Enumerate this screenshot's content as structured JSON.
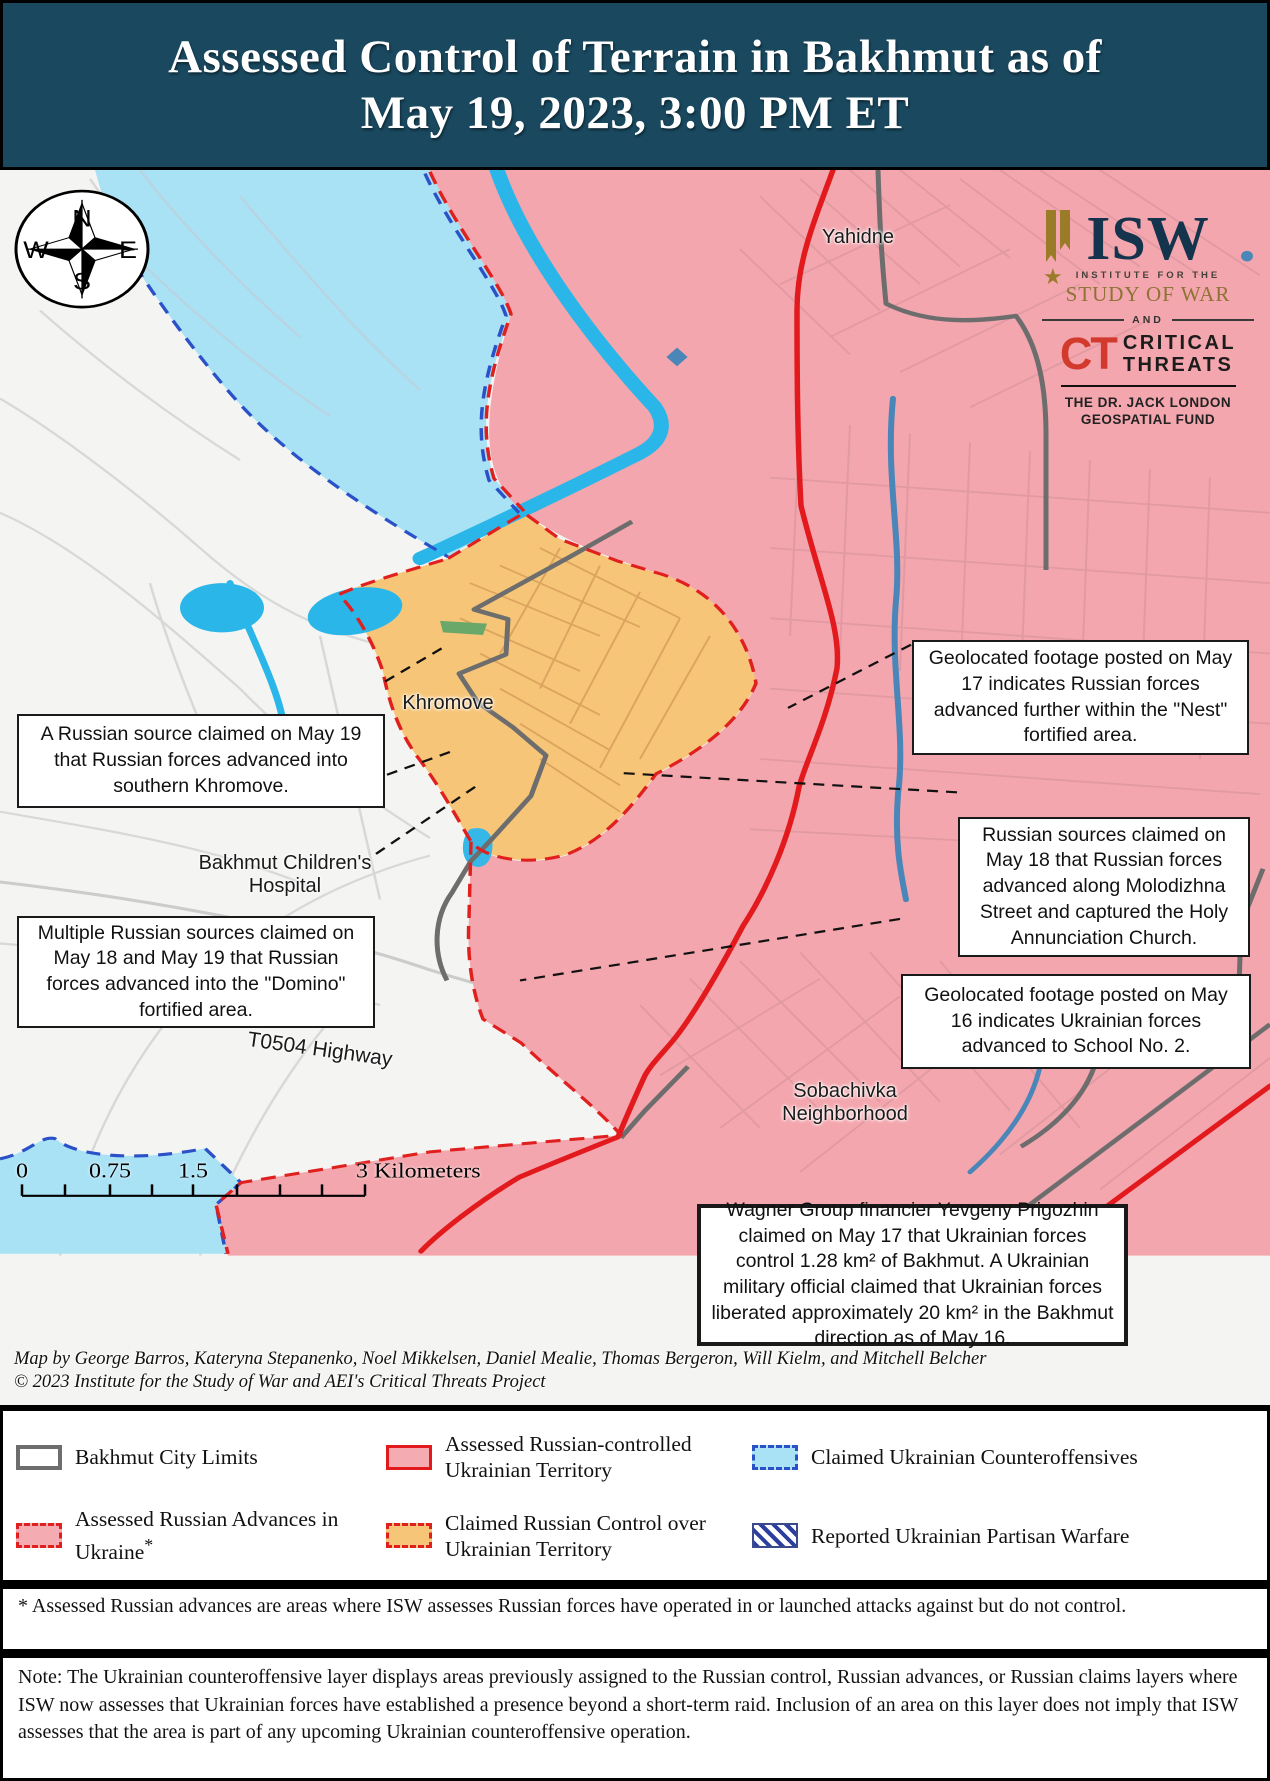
{
  "header": {
    "title_line1": "Assessed Control of Terrain in Bakhmut as of",
    "title_line2": "May 19, 2023, 3:00 PM ET"
  },
  "logo": {
    "isw": "ISW",
    "institute": "INSTITUTE FOR THE",
    "study": "STUDY OF WAR",
    "and": "AND",
    "ct": "CT",
    "critical": "CRITICAL",
    "threats": "THREATS",
    "fund_line1": "THE DR. JACK LONDON",
    "fund_line2": "GEOSPATIAL FUND"
  },
  "compass": {
    "n": "N",
    "e": "E",
    "s": "S",
    "w": "W"
  },
  "map_labels": {
    "yahidne": "Yahidne",
    "khromove": "Khromove",
    "hospital": "Bakhmut Children's Hospital",
    "highway": "T0504 Highway",
    "sobachivka": "Sobachivka Neighborhood"
  },
  "callouts": [
    {
      "text": "A Russian source claimed on May 19 that Russian forces advanced into southern Khromove."
    },
    {
      "text": "Multiple Russian sources claimed on May 18 and May 19 that Russian forces advanced into the \"Domino\" fortified area."
    },
    {
      "text": "Geolocated footage posted on May 17 indicates Russian forces advanced further within the \"Nest\" fortified area."
    },
    {
      "text": "Russian sources claimed on May 18 that Russian forces advanced along Molodizhna Street and captured the Holy Annunciation Church."
    },
    {
      "text": "Geolocated footage posted on May 16 indicates Ukrainian forces advanced to School No. 2."
    },
    {
      "text": "Wagner Group financier Yevgeny Prigozhin claimed on May 17 that Ukrainian forces control 1.28 km² of Bakhmut. A Ukrainian military official claimed that Ukrainian forces liberated approximately 20 km² in the Bakhmut direction as of May 16."
    }
  ],
  "scale": {
    "t0": "0",
    "t075": "0.75",
    "t15": "1.5",
    "t3": "3 Kilometers"
  },
  "credits": {
    "line1": "Map by George Barros, Kateryna Stepanenko, Noel Mikkelsen, Daniel Mealie, Thomas Bergeron, Will Kielm, and Mitchell Belcher",
    "line2": "© 2023 Institute for the Study of War and AEI's Critical Threats Project"
  },
  "legend": {
    "items": [
      {
        "label": "Bakhmut City Limits",
        "sup": ""
      },
      {
        "label": "Assessed Russian Advances in Ukraine",
        "sup": "*"
      },
      {
        "label": "Assessed Russian-controlled Ukrainian Territory",
        "sup": ""
      },
      {
        "label": "Claimed Russian Control over Ukrainian Territory",
        "sup": ""
      },
      {
        "label": "Claimed Ukrainian Counteroffensives",
        "sup": ""
      },
      {
        "label": "Reported Ukrainian Partisan Warfare",
        "sup": ""
      }
    ]
  },
  "footnotes": {
    "asterisk": "* Assessed Russian advances are areas where ISW assesses Russian forces have operated in or launched attacks against but do not control.",
    "note": "Note: The Ukrainian counteroffensive layer displays areas previously assigned to the Russian control, Russian advances, or Russian claims layers where ISW now assesses that Ukrainian forces have established a presence beyond a short-term raid. Inclusion of an area on this layer does not imply that ISW assesses that the area is part of any upcoming Ukrainian counteroffensive operation."
  },
  "colors": {
    "header_bg": "#19485f",
    "russian_controlled": "#f3a6ad",
    "claimed_russian": "#f6c577",
    "ukrainian_counteroffensive": "#a9e2f5",
    "water": "#2ab6e9",
    "front_line_red": "#e31a1d",
    "advance_dash_red": "#e0201f",
    "counter_dash_blue": "#2b51c8",
    "city_limits_gray": "#6d6d6d"
  }
}
